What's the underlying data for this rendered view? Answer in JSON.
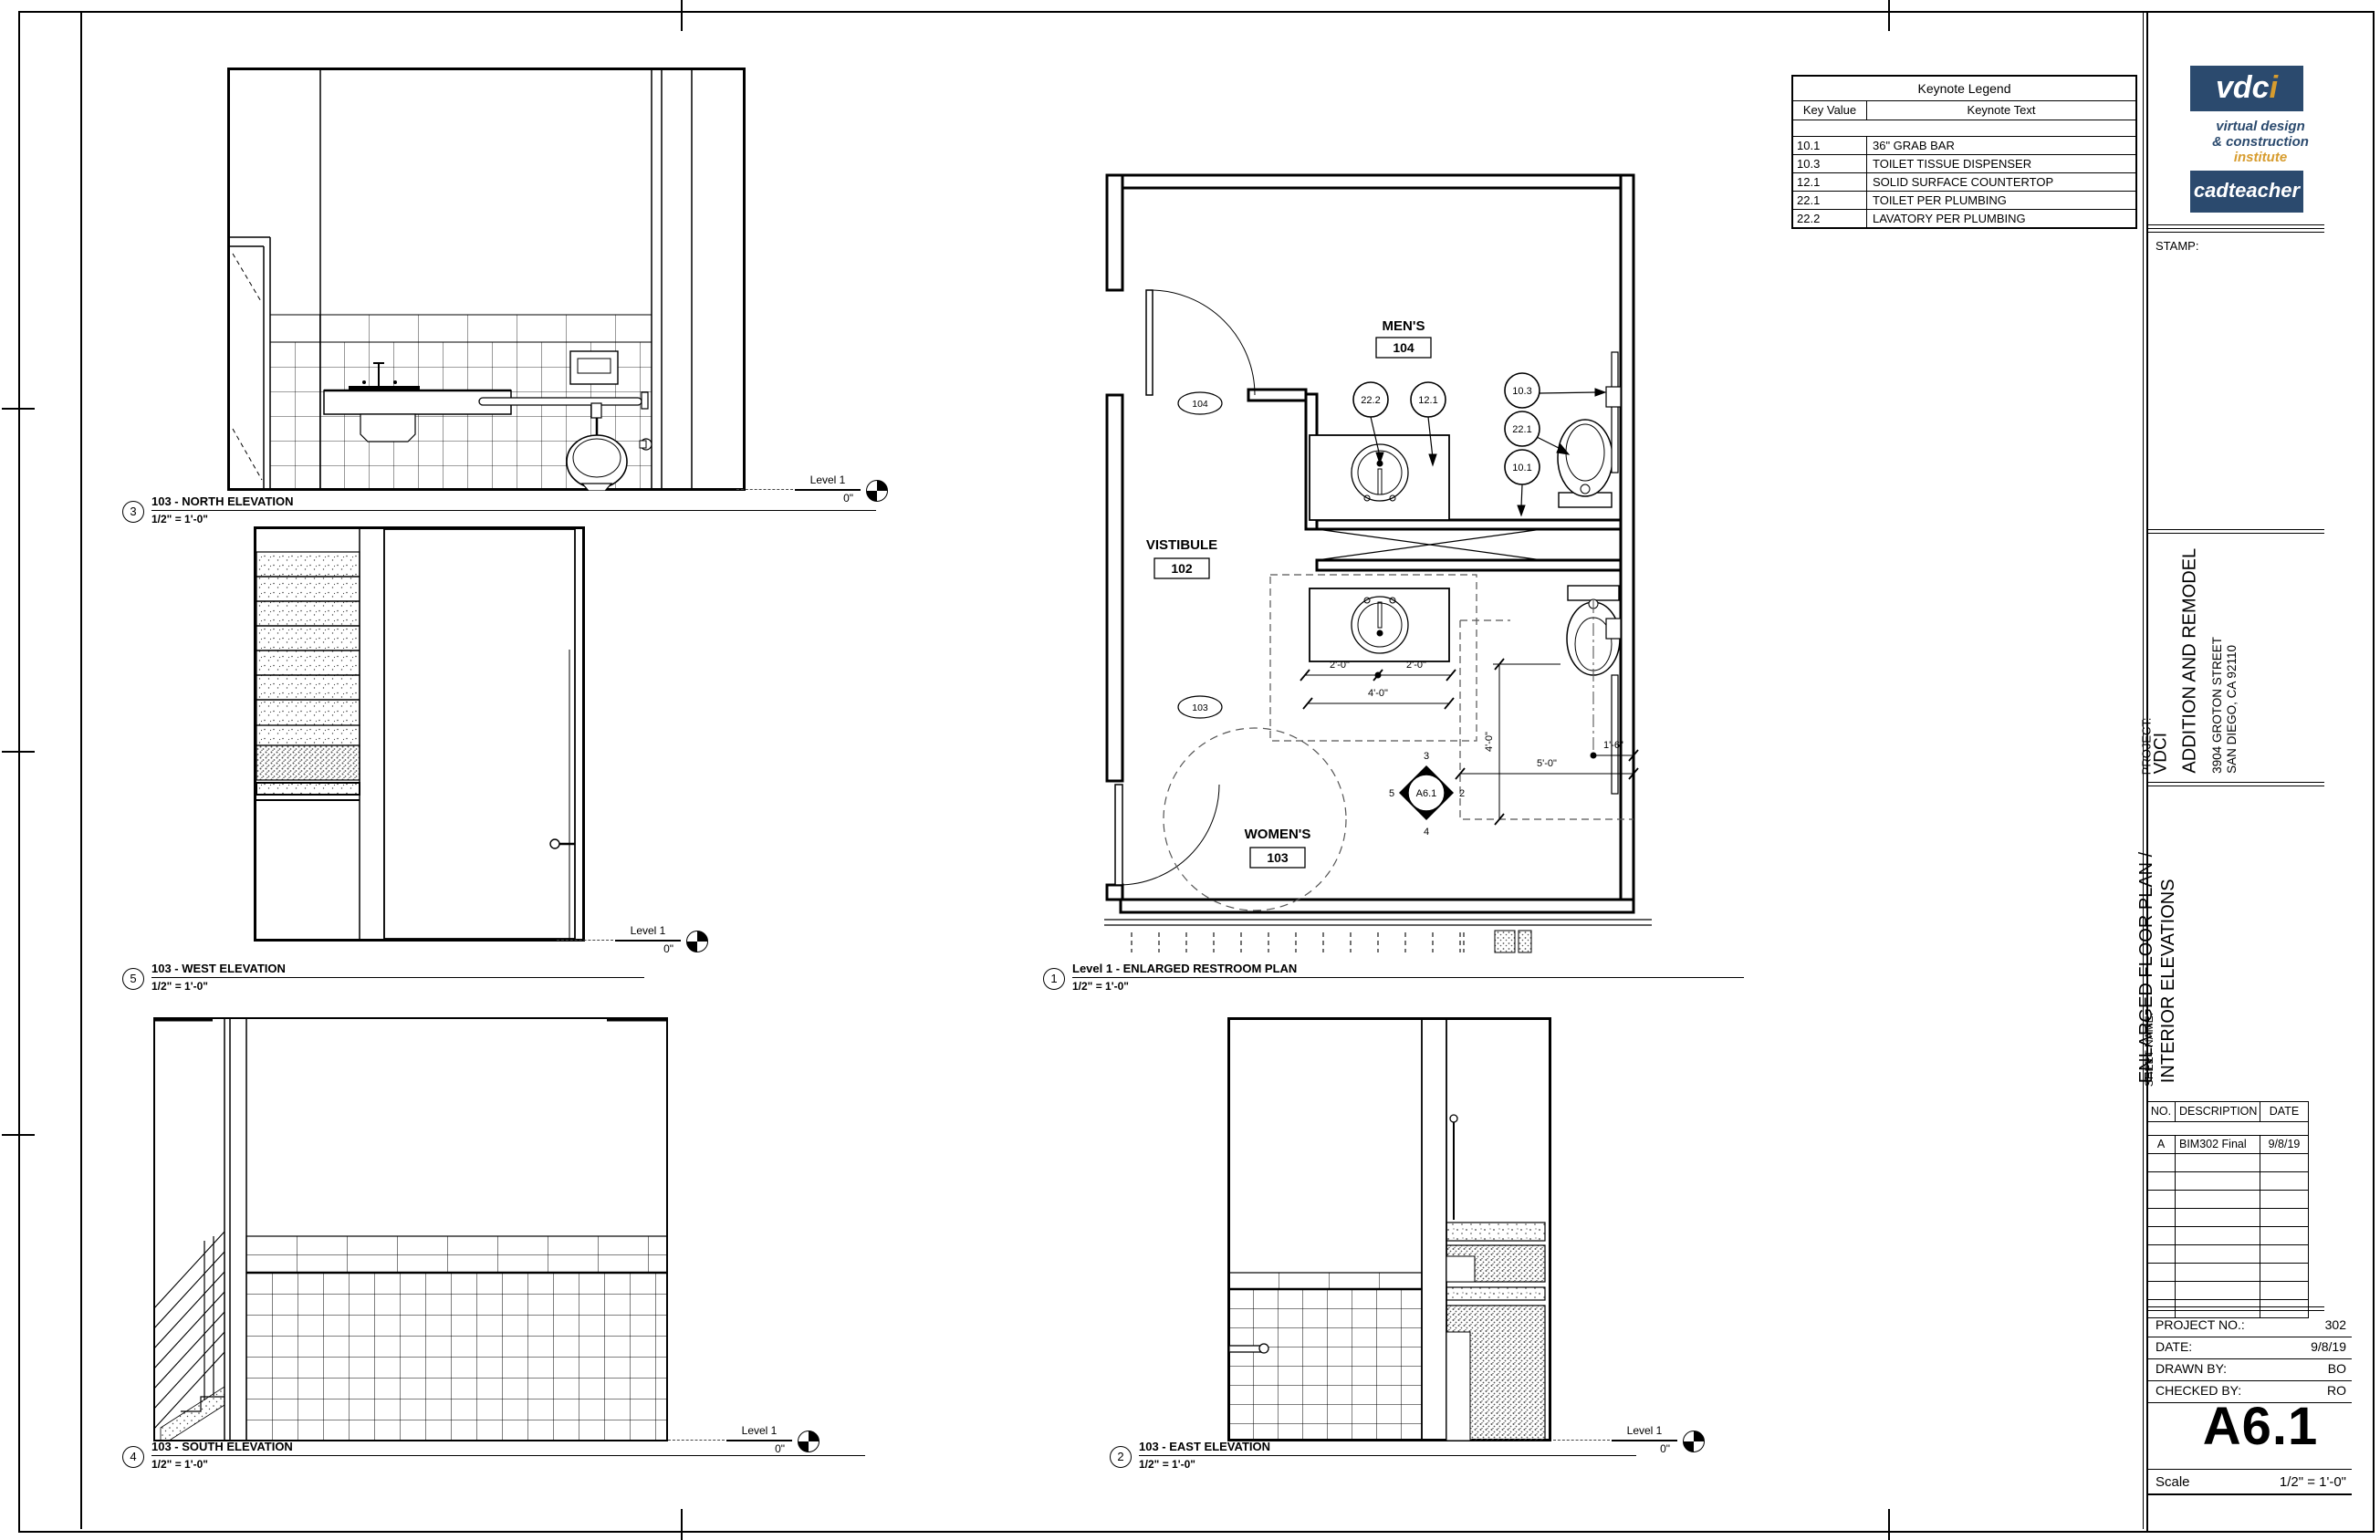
{
  "colors": {
    "navy": "#2b4a6e",
    "gold": "#d79c2e",
    "line": "#000000",
    "paper": "#ffffff"
  },
  "keynote_legend": {
    "title": "Keynote Legend",
    "headers": {
      "key": "Key Value",
      "text": "Keynote Text"
    },
    "rows": [
      {
        "key": "10.1",
        "text": "36\" GRAB BAR"
      },
      {
        "key": "10.3",
        "text": "TOILET TISSUE DISPENSER"
      },
      {
        "key": "12.1",
        "text": "SOLID SURFACE COUNTERTOP"
      },
      {
        "key": "22.1",
        "text": "TOILET PER PLUMBING"
      },
      {
        "key": "22.2",
        "text": "LAVATORY PER PLUMBING"
      }
    ]
  },
  "titleblock": {
    "logo": {
      "brand_white": "vdc",
      "brand_gold": "i",
      "tagline1": "virtual design",
      "tagline2": "& construction",
      "tagline3": "institute",
      "subbrand": "cadteacher"
    },
    "stamp_label": "STAMP:",
    "project": {
      "label": "PROJECT:",
      "client": "VDCI",
      "title": "ADDITION AND REMODEL",
      "address1": "3904 GROTON STREET",
      "address2": "SAN DIEGO, CA 92110"
    },
    "sheet_name": {
      "label": "SHEET NAME:",
      "line1": "ENLARGED FLOOR PLAN /",
      "line2": "INTERIOR ELEVATIONS"
    },
    "revisions": {
      "no": "NO.",
      "description": "DESCRIPTION",
      "date": "DATE",
      "rows": [
        {
          "no": "A",
          "description": "BIM302 Final",
          "date": "9/8/19"
        }
      ]
    },
    "info": {
      "project_no_label": "PROJECT NO.:",
      "project_no": "302",
      "date_label": "DATE:",
      "date": "9/8/19",
      "drawn_label": "DRAWN BY:",
      "drawn": "BO",
      "checked_label": "CHECKED BY:",
      "checked": "RO"
    },
    "sheet_number": "A6.1",
    "scale_label": "Scale",
    "scale_value": "1/2\" = 1'-0\""
  },
  "level_marker": {
    "name": "Level 1",
    "value": "0\""
  },
  "views": {
    "plan": {
      "num": "1",
      "title": "Level 1 - ENLARGED RESTROOM PLAN",
      "scale": "1/2\" = 1'-0\""
    },
    "east": {
      "num": "2",
      "title": "103 - EAST ELEVATION",
      "scale": "1/2\" = 1'-0\""
    },
    "north": {
      "num": "3",
      "title": "103 - NORTH ELEVATION",
      "scale": "1/2\" = 1'-0\""
    },
    "south": {
      "num": "4",
      "title": "103 - SOUTH ELEVATION",
      "scale": "1/2\" = 1'-0\""
    },
    "west": {
      "num": "5",
      "title": "103 - WEST ELEVATION",
      "scale": "1/2\" = 1'-0\""
    }
  },
  "plan": {
    "rooms": {
      "mens": {
        "name": "MEN'S",
        "number": "104"
      },
      "vestibule": {
        "name": "VISTIBULE",
        "number": "102"
      },
      "womens": {
        "name": "WOMEN'S",
        "number": "103"
      }
    },
    "door_tags": {
      "mens": "104",
      "womens": "103"
    },
    "keynotes": {
      "k22_2": "22.2",
      "k12_1": "12.1",
      "k10_3": "10.3",
      "k22_1": "22.1",
      "k10_1": "10.1"
    },
    "dims": {
      "sink_left": "2'-0\"",
      "sink_right": "2'-0\"",
      "sink_total": "4'-0\"",
      "toilet_side": "1'-6\"",
      "toilet_front": "5'-0\"",
      "toilet_depth": "4'-0\""
    },
    "callout": {
      "sheet": "A6.1",
      "top": "3",
      "right": "2",
      "bottom": "4",
      "left": "5"
    }
  }
}
